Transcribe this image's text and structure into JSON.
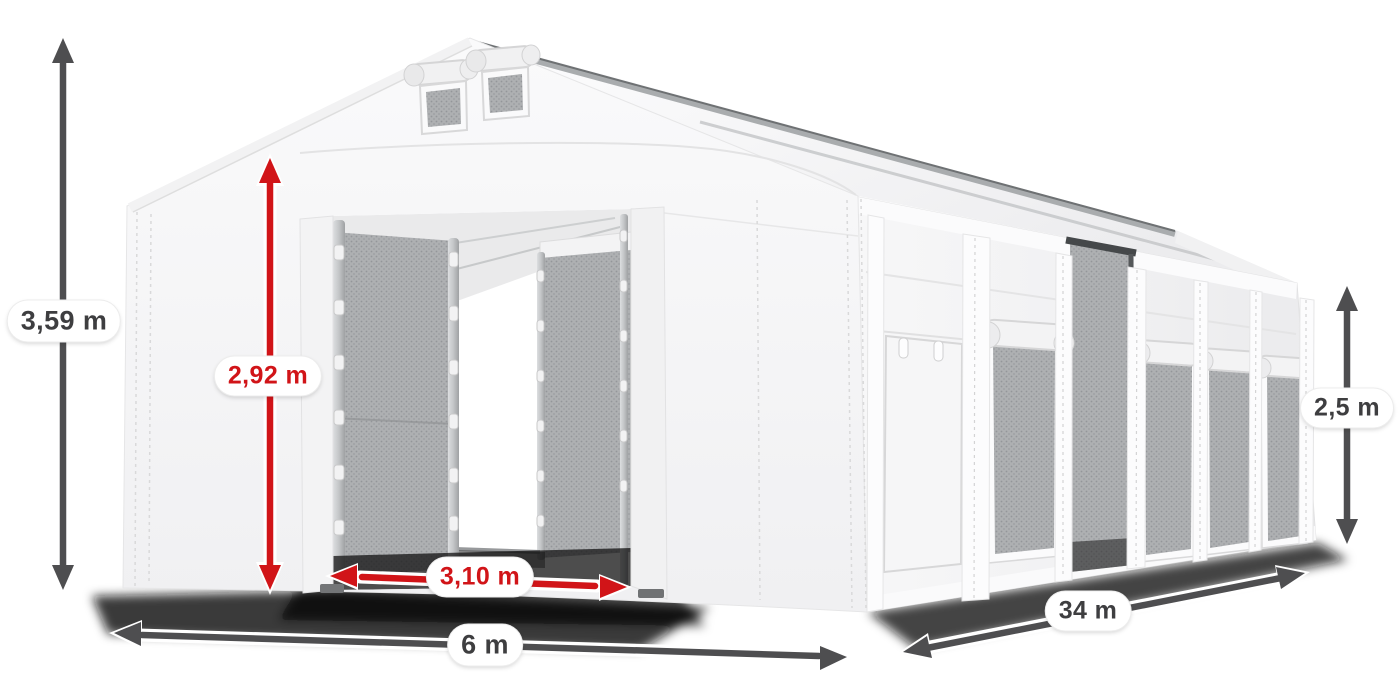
{
  "figure": {
    "type": "product dimension diagram",
    "subject": "White PVC storage tent with open gable gates, mesh windows and side door",
    "units": "m",
    "dimensions": {
      "total_height": "3,59 m",
      "door_height": "2,92 m",
      "door_width": "3,10 m",
      "width": "6 m",
      "length": "34 m",
      "side_height": "2,5 m"
    },
    "colors": {
      "dimension_red": "#d11418",
      "dimension_gray": "#4e4e50",
      "label_text_gray": "#3e3e40",
      "label_background": "#ffffff",
      "tent_white": "#f7f7f8",
      "mesh_gray": "#a9abad"
    }
  }
}
